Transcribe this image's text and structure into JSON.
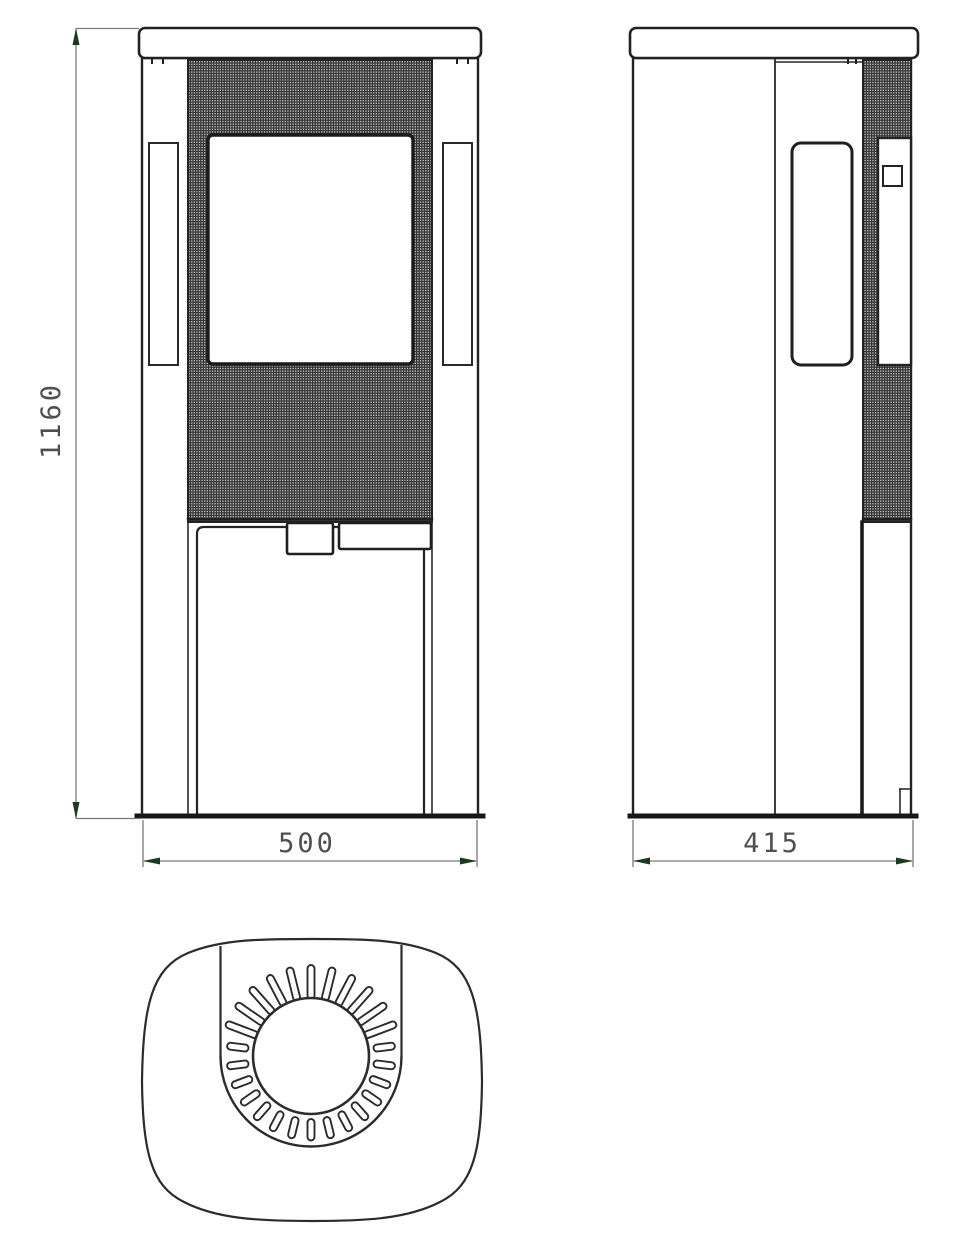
{
  "drawing": {
    "description": "stove-three-view-technical-drawing",
    "views": {
      "front": "front-view",
      "side": "side-view",
      "top": "top-view"
    }
  },
  "dimensions": {
    "height": {
      "value": "1160"
    },
    "width": {
      "value": "500"
    },
    "depth": {
      "value": "415"
    }
  },
  "colors": {
    "outline": "#222222",
    "dim_line": "#7a7a7a",
    "arrow": "#1e3a1e",
    "dim_text": "#4f4f4f",
    "mesh_background": "#bfbfbf",
    "mesh_line": "#343434",
    "fill": "#ffffff"
  },
  "top_view_geometry": {
    "cx": 311,
    "cy": 1056,
    "inner_radius": 58,
    "outer_radius": 90.5,
    "slot_count": 26,
    "slot_width": 7,
    "slot_short": [
      63,
      84.5
    ],
    "slot_long": [
      57,
      91
    ],
    "top_sector_deg": [
      192,
      348
    ]
  }
}
